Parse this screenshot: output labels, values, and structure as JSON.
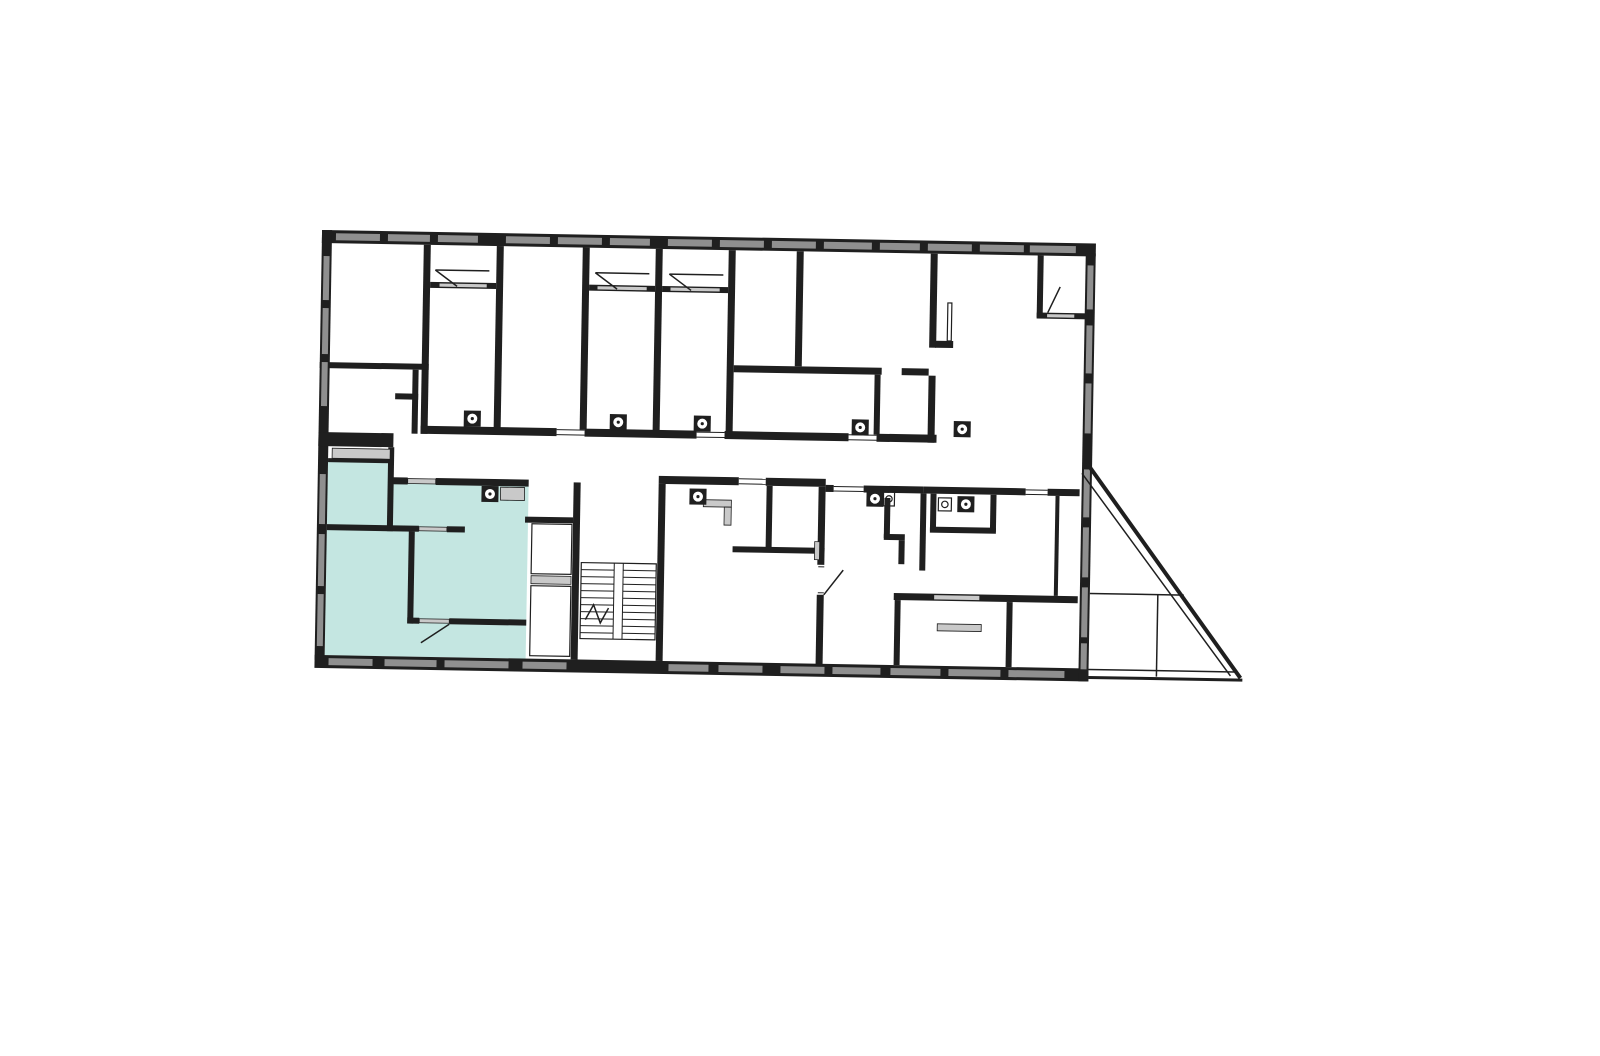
{
  "page": {
    "background_color": "#ffffff",
    "content_type": "architectural floor plan, no text labels"
  },
  "colors": {
    "wall": "#1f1f1f",
    "window": "#8f8f8f",
    "sill": "#c9c9c9",
    "highlight": "#c4e6e1",
    "background": "#ffffff",
    "line": "#1f1f1f"
  },
  "floor_plan": {
    "type": "building-storey-plan",
    "highlighted_unit": {
      "present": true,
      "fill": "#c4e6e1",
      "position": "bottom-left",
      "room_count_visible": 4
    },
    "staircase": {
      "flights": 2,
      "treads_per_flight": 10,
      "break_mark": true
    },
    "terrace_triangle": {
      "position": "bottom-right"
    },
    "appliance_fixture_count": 9,
    "door_swing_count": 7
  }
}
